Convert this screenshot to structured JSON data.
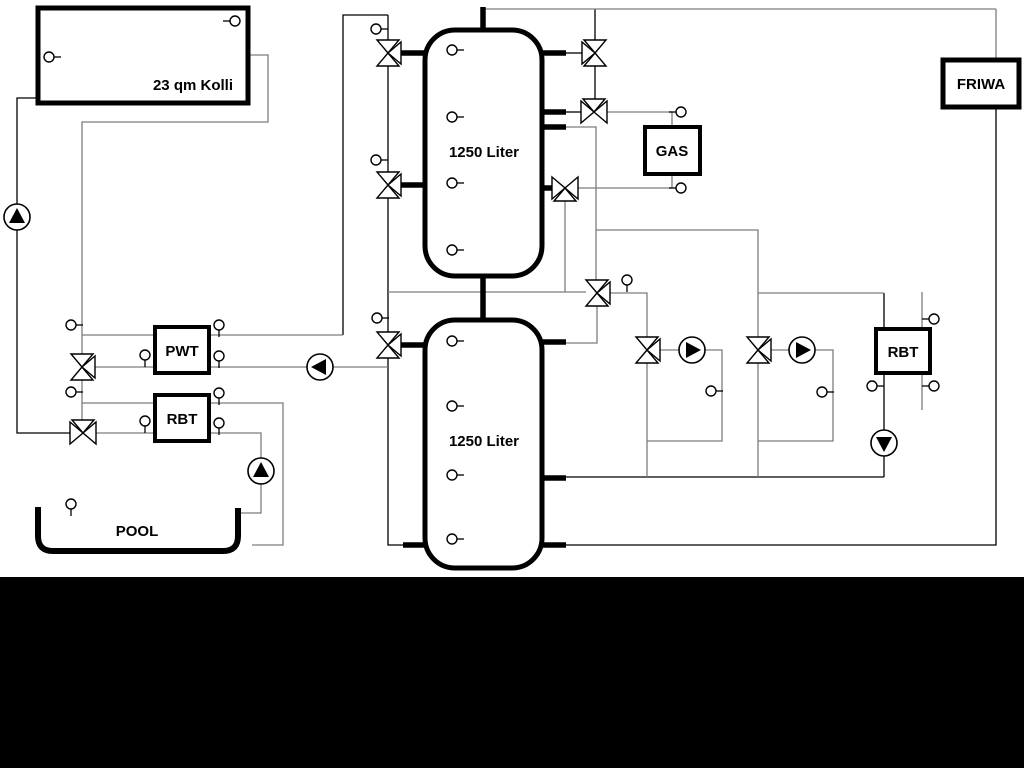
{
  "colors": {
    "gray": "#7d7d7d",
    "black": "#000000",
    "background": "#ffffff",
    "bottom_band": "#000000"
  },
  "bottom_band": {
    "x": 0,
    "y": 577,
    "w": 1024,
    "h": 191
  },
  "labels": {
    "collector": "23 qm Kolli",
    "tank1": "1250 Liter",
    "tank2": "1250 Liter",
    "gas": "GAS",
    "friwa": "FRIWA",
    "pwt": "PWT",
    "rbt_left": "RBT",
    "rbt_right": "RBT",
    "pool": "POOL"
  },
  "boxes": [
    {
      "name": "collector-box",
      "x": 38,
      "y": 8,
      "w": 210,
      "h": 95,
      "sw": 5
    },
    {
      "name": "gas-box",
      "x": 645,
      "y": 127,
      "w": 55,
      "h": 47,
      "sw": 4
    },
    {
      "name": "friwa-box",
      "x": 943,
      "y": 60,
      "w": 76,
      "h": 47,
      "sw": 5
    },
    {
      "name": "pwt-box",
      "x": 155,
      "y": 327,
      "w": 54,
      "h": 46,
      "sw": 4
    },
    {
      "name": "rbt-left-box",
      "x": 155,
      "y": 395,
      "w": 54,
      "h": 46,
      "sw": 4
    },
    {
      "name": "rbt-right-box",
      "x": 876,
      "y": 329,
      "w": 54,
      "h": 44,
      "sw": 4
    }
  ],
  "tanks": [
    {
      "name": "buffer-tank-1",
      "x": 425,
      "y": 30,
      "w": 117,
      "h": 246,
      "r": 30,
      "sw": 5
    },
    {
      "name": "buffer-tank-2",
      "x": 425,
      "y": 320,
      "w": 117,
      "h": 248,
      "r": 30,
      "sw": 5
    }
  ],
  "pool": {
    "name": "pool-basin",
    "path": "M 38 507 L 38 536 Q 38 551 53 551 L 223 551 Q 238 551 238 536 L 238 508",
    "sw": 6
  },
  "text_labels": [
    {
      "name": "collector-label",
      "x": 233,
      "y": 90,
      "anchor": "end",
      "size": 15,
      "key": "collector"
    },
    {
      "name": "tank1-label",
      "x": 484,
      "y": 157,
      "anchor": "middle",
      "size": 15,
      "key": "tank1"
    },
    {
      "name": "tank2-label",
      "x": 484,
      "y": 446,
      "anchor": "middle",
      "size": 15,
      "key": "tank2"
    },
    {
      "name": "gas-label",
      "x": 672,
      "y": 156,
      "anchor": "middle",
      "size": 15,
      "key": "gas"
    },
    {
      "name": "friwa-label",
      "x": 981,
      "y": 89,
      "anchor": "middle",
      "size": 15,
      "key": "friwa"
    },
    {
      "name": "pwt-label",
      "x": 182,
      "y": 356,
      "anchor": "middle",
      "size": 15,
      "key": "pwt"
    },
    {
      "name": "rbt-left-label",
      "x": 182,
      "y": 424,
      "anchor": "middle",
      "size": 15,
      "key": "rbt_left"
    },
    {
      "name": "rbt-right-label",
      "x": 903,
      "y": 357,
      "anchor": "middle",
      "size": 15,
      "key": "rbt_right"
    },
    {
      "name": "pool-label",
      "x": 137,
      "y": 536,
      "anchor": "middle",
      "size": 15,
      "key": "pool"
    }
  ],
  "thick_pipes": [
    {
      "pts": [
        [
          483,
          7
        ],
        [
          483,
          33
        ]
      ]
    },
    {
      "pts": [
        [
          483,
          276
        ],
        [
          483,
          320
        ]
      ]
    },
    {
      "pts": [
        [
          399,
          53
        ],
        [
          427,
          53
        ]
      ]
    },
    {
      "pts": [
        [
          399,
          185
        ],
        [
          427,
          185
        ]
      ]
    },
    {
      "pts": [
        [
          399,
          345
        ],
        [
          427,
          345
        ]
      ]
    },
    {
      "pts": [
        [
          542,
          53
        ],
        [
          566,
          53
        ]
      ]
    },
    {
      "pts": [
        [
          542,
          112
        ],
        [
          566,
          112
        ]
      ]
    },
    {
      "pts": [
        [
          542,
          127
        ],
        [
          566,
          127
        ]
      ]
    },
    {
      "pts": [
        [
          542,
          188
        ],
        [
          553,
          188
        ]
      ]
    },
    {
      "pts": [
        [
          542,
          342
        ],
        [
          566,
          342
        ]
      ]
    },
    {
      "pts": [
        [
          542,
          478
        ],
        [
          566,
          478
        ]
      ]
    },
    {
      "pts": [
        [
          542,
          545
        ],
        [
          566,
          545
        ]
      ]
    },
    {
      "pts": [
        [
          403,
          545
        ],
        [
          427,
          545
        ]
      ]
    }
  ],
  "thin_pipes": [
    {
      "c": "k",
      "pts": [
        [
          38,
          98
        ],
        [
          17,
          98
        ],
        [
          17,
          433
        ],
        [
          70,
          433
        ]
      ]
    },
    {
      "c": "k",
      "pts": [
        [
          343,
          335
        ],
        [
          343,
          15
        ],
        [
          388,
          15
        ]
      ]
    },
    {
      "c": "k",
      "pts": [
        [
          388,
          15
        ],
        [
          388,
          40
        ]
      ]
    },
    {
      "c": "k",
      "pts": [
        [
          388,
          66
        ],
        [
          388,
          172
        ]
      ]
    },
    {
      "c": "k",
      "pts": [
        [
          388,
          198
        ],
        [
          388,
          332
        ]
      ]
    },
    {
      "c": "k",
      "pts": [
        [
          388,
          358
        ],
        [
          388,
          545
        ],
        [
          403,
          545
        ]
      ]
    },
    {
      "c": "k",
      "pts": [
        [
          566,
          53
        ],
        [
          582,
          53
        ]
      ]
    },
    {
      "c": "k",
      "pts": [
        [
          566,
          112
        ],
        [
          581,
          112
        ]
      ]
    },
    {
      "c": "k",
      "pts": [
        [
          595,
          9
        ],
        [
          595,
          40
        ]
      ]
    },
    {
      "c": "k",
      "pts": [
        [
          595,
          66
        ],
        [
          595,
          99
        ]
      ]
    },
    {
      "c": "k",
      "pts": [
        [
          566,
          477
        ],
        [
          884,
          477
        ]
      ]
    },
    {
      "c": "k",
      "pts": [
        [
          566,
          545
        ],
        [
          996,
          545
        ],
        [
          996,
          107
        ]
      ]
    },
    {
      "c": "k",
      "pts": [
        [
          884,
          293
        ],
        [
          884,
          329
        ]
      ]
    },
    {
      "c": "k",
      "pts": [
        [
          884,
          373
        ],
        [
          884,
          430
        ]
      ]
    },
    {
      "c": "k",
      "pts": [
        [
          884,
          456
        ],
        [
          884,
          477
        ]
      ]
    },
    {
      "c": "g",
      "pts": [
        [
          248,
          55
        ],
        [
          268,
          55
        ],
        [
          268,
          122
        ],
        [
          82,
          122
        ],
        [
          82,
          354
        ]
      ]
    },
    {
      "c": "g",
      "pts": [
        [
          82,
          380
        ],
        [
          82,
          420
        ]
      ]
    },
    {
      "c": "g",
      "pts": [
        [
          82,
          335
        ],
        [
          155,
          335
        ]
      ]
    },
    {
      "c": "g",
      "pts": [
        [
          95,
          367
        ],
        [
          155,
          367
        ]
      ]
    },
    {
      "c": "g",
      "pts": [
        [
          209,
          335
        ],
        [
          343,
          335
        ]
      ]
    },
    {
      "c": "g",
      "pts": [
        [
          82,
          403
        ],
        [
          155,
          403
        ]
      ]
    },
    {
      "c": "g",
      "pts": [
        [
          96,
          433
        ],
        [
          155,
          433
        ]
      ]
    },
    {
      "c": "g",
      "pts": [
        [
          209,
          403
        ],
        [
          283,
          403
        ],
        [
          283,
          545
        ],
        [
          252,
          545
        ]
      ]
    },
    {
      "c": "g",
      "pts": [
        [
          209,
          433
        ],
        [
          261,
          433
        ],
        [
          261,
          458
        ]
      ]
    },
    {
      "c": "g",
      "pts": [
        [
          261,
          484
        ],
        [
          261,
          513
        ],
        [
          240,
          513
        ]
      ]
    },
    {
      "c": "g",
      "pts": [
        [
          209,
          367
        ],
        [
          307,
          367
        ]
      ]
    },
    {
      "c": "g",
      "pts": [
        [
          333,
          367
        ],
        [
          388,
          367
        ]
      ]
    },
    {
      "c": "g",
      "pts": [
        [
          388,
          292
        ],
        [
          586,
          292
        ]
      ]
    },
    {
      "c": "g",
      "pts": [
        [
          565,
          201
        ],
        [
          565,
          292
        ]
      ]
    },
    {
      "c": "g",
      "pts": [
        [
          610,
          293
        ],
        [
          647,
          293
        ],
        [
          647,
          337
        ]
      ]
    },
    {
      "c": "g",
      "pts": [
        [
          597,
          306
        ],
        [
          597,
          343
        ],
        [
          566,
          343
        ]
      ]
    },
    {
      "c": "g",
      "pts": [
        [
          566,
          127
        ],
        [
          596,
          127
        ],
        [
          596,
          280
        ]
      ]
    },
    {
      "c": "g",
      "pts": [
        [
          596,
          230
        ],
        [
          758,
          230
        ],
        [
          758,
          337
        ]
      ]
    },
    {
      "c": "g",
      "pts": [
        [
          758,
          293
        ],
        [
          884,
          293
        ]
      ]
    },
    {
      "c": "g",
      "pts": [
        [
          758,
          363
        ],
        [
          758,
          477
        ]
      ]
    },
    {
      "c": "g",
      "pts": [
        [
          815,
          350
        ],
        [
          833,
          350
        ],
        [
          833,
          441
        ],
        [
          758,
          441
        ]
      ]
    },
    {
      "c": "g",
      "pts": [
        [
          771,
          350
        ],
        [
          789,
          350
        ]
      ]
    },
    {
      "c": "g",
      "pts": [
        [
          660,
          350
        ],
        [
          679,
          350
        ]
      ]
    },
    {
      "c": "g",
      "pts": [
        [
          705,
          350
        ],
        [
          722,
          350
        ],
        [
          722,
          441
        ],
        [
          647,
          441
        ]
      ]
    },
    {
      "c": "g",
      "pts": [
        [
          647,
          363
        ],
        [
          647,
          477
        ]
      ]
    },
    {
      "c": "g",
      "pts": [
        [
          607,
          112
        ],
        [
          672,
          112
        ]
      ]
    },
    {
      "c": "g",
      "pts": [
        [
          672,
          112
        ],
        [
          672,
          127
        ]
      ]
    },
    {
      "c": "g",
      "pts": [
        [
          578,
          188
        ],
        [
          672,
          188
        ]
      ]
    },
    {
      "c": "g",
      "pts": [
        [
          672,
          174
        ],
        [
          672,
          188
        ]
      ]
    },
    {
      "c": "g",
      "pts": [
        [
          483,
          9
        ],
        [
          996,
          9
        ]
      ]
    },
    {
      "c": "g",
      "pts": [
        [
          996,
          9
        ],
        [
          996,
          60
        ]
      ]
    },
    {
      "c": "g",
      "pts": [
        [
          922,
          292
        ],
        [
          922,
          410
        ]
      ]
    }
  ],
  "valves": [
    {
      "name": "tank1-left-top-valve",
      "x": 388,
      "y": 53,
      "o": "v",
      "b": "right"
    },
    {
      "name": "tank1-left-bottom-valve",
      "x": 388,
      "y": 185,
      "o": "v",
      "b": "right"
    },
    {
      "name": "tank2-left-valve",
      "x": 388,
      "y": 345,
      "o": "v",
      "b": "right"
    },
    {
      "name": "pwt-valve",
      "x": 82,
      "y": 367,
      "o": "v",
      "b": "right"
    },
    {
      "name": "pool-rbt-valve",
      "x": 83,
      "y": 433,
      "o": "h",
      "b": "top"
    },
    {
      "name": "tank1-right-top-valve",
      "x": 595,
      "y": 53,
      "o": "v",
      "b": "left"
    },
    {
      "name": "gas-supply-valve",
      "x": 594,
      "y": 112,
      "o": "h",
      "b": "top"
    },
    {
      "name": "gas-return-valve",
      "x": 565,
      "y": 188,
      "o": "h",
      "b": "bottom"
    },
    {
      "name": "mixing-valve",
      "x": 597,
      "y": 293,
      "o": "v",
      "b": "right"
    },
    {
      "name": "heating-circuit-1-valve",
      "x": 647,
      "y": 350,
      "o": "v",
      "b": "right"
    },
    {
      "name": "heating-circuit-2-valve",
      "x": 758,
      "y": 350,
      "o": "v",
      "b": "right"
    }
  ],
  "pumps": [
    {
      "name": "solar-pump",
      "x": 17,
      "y": 217,
      "dir": "up"
    },
    {
      "name": "heat-exchanger-pump",
      "x": 320,
      "y": 367,
      "dir": "left"
    },
    {
      "name": "pool-pump",
      "x": 261,
      "y": 471,
      "dir": "up"
    },
    {
      "name": "heating-circuit-1-pump",
      "x": 692,
      "y": 350,
      "dir": "right"
    },
    {
      "name": "heating-circuit-2-pump",
      "x": 802,
      "y": 350,
      "dir": "right"
    },
    {
      "name": "rbt-recirculation-pump",
      "x": 884,
      "y": 443,
      "dir": "down"
    }
  ],
  "sensors": [
    {
      "x": 235,
      "y": 21,
      "stem": "l"
    },
    {
      "x": 49,
      "y": 57,
      "stem": "r"
    },
    {
      "x": 452,
      "y": 50,
      "stem": "r"
    },
    {
      "x": 452,
      "y": 117,
      "stem": "r"
    },
    {
      "x": 452,
      "y": 183,
      "stem": "r"
    },
    {
      "x": 452,
      "y": 250,
      "stem": "r"
    },
    {
      "x": 452,
      "y": 341,
      "stem": "r"
    },
    {
      "x": 452,
      "y": 406,
      "stem": "r"
    },
    {
      "x": 452,
      "y": 475,
      "stem": "r"
    },
    {
      "x": 452,
      "y": 539,
      "stem": "r"
    },
    {
      "x": 376,
      "y": 29,
      "stem": "r"
    },
    {
      "x": 376,
      "y": 160,
      "stem": "r"
    },
    {
      "x": 377,
      "y": 318,
      "stem": "r"
    },
    {
      "x": 71,
      "y": 325,
      "stem": "r"
    },
    {
      "x": 71,
      "y": 392,
      "stem": "r"
    },
    {
      "x": 145,
      "y": 355,
      "stem": "d"
    },
    {
      "x": 145,
      "y": 421,
      "stem": "d"
    },
    {
      "x": 219,
      "y": 325,
      "stem": "d"
    },
    {
      "x": 219,
      "y": 356,
      "stem": "d"
    },
    {
      "x": 219,
      "y": 393,
      "stem": "d"
    },
    {
      "x": 219,
      "y": 423,
      "stem": "d"
    },
    {
      "x": 71,
      "y": 504,
      "stem": "d"
    },
    {
      "x": 627,
      "y": 280,
      "stem": "d"
    },
    {
      "x": 681,
      "y": 112,
      "stem": "l"
    },
    {
      "x": 681,
      "y": 188,
      "stem": "l"
    },
    {
      "x": 711,
      "y": 391,
      "stem": "r"
    },
    {
      "x": 822,
      "y": 392,
      "stem": "r"
    },
    {
      "x": 872,
      "y": 386,
      "stem": "r"
    },
    {
      "x": 934,
      "y": 319,
      "stem": "l"
    },
    {
      "x": 934,
      "y": 386,
      "stem": "l"
    }
  ]
}
